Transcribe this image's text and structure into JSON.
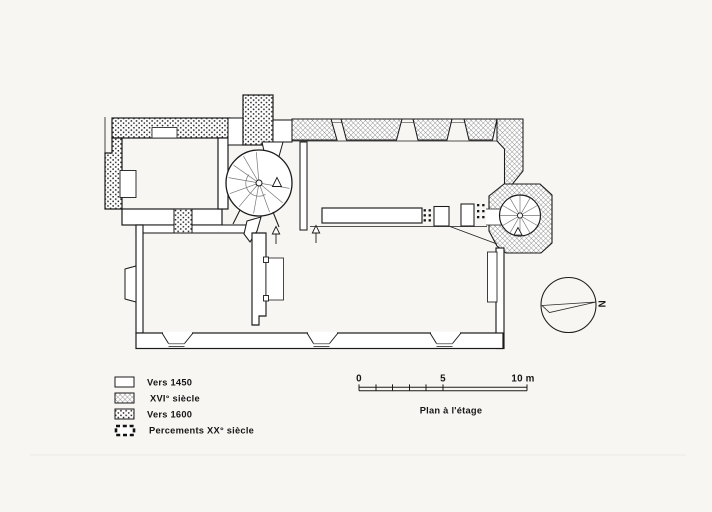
{
  "plan": {
    "caption": "Plan à l'étage",
    "compass": {
      "letter": "N"
    }
  },
  "legend": {
    "items": [
      {
        "key": "vers-1450",
        "pattern": "plain",
        "label": "Vers 1450"
      },
      {
        "key": "xvi-siecle",
        "pattern": "crosshatch",
        "label": "XVI° siècle"
      },
      {
        "key": "vers-1600",
        "pattern": "stipple",
        "label": "Vers 1600"
      },
      {
        "key": "percements-xx-siecle",
        "pattern": "black-dash",
        "label": "Percements XX° siècle"
      }
    ]
  },
  "scale_bar": {
    "labels": {
      "start": "0",
      "mid": "5",
      "end": "10 m"
    },
    "unit": "m"
  },
  "colors": {
    "paper": "#f7f6f3",
    "ink": "#1b1b1b",
    "hatch_gray": "#6e6e6e"
  }
}
